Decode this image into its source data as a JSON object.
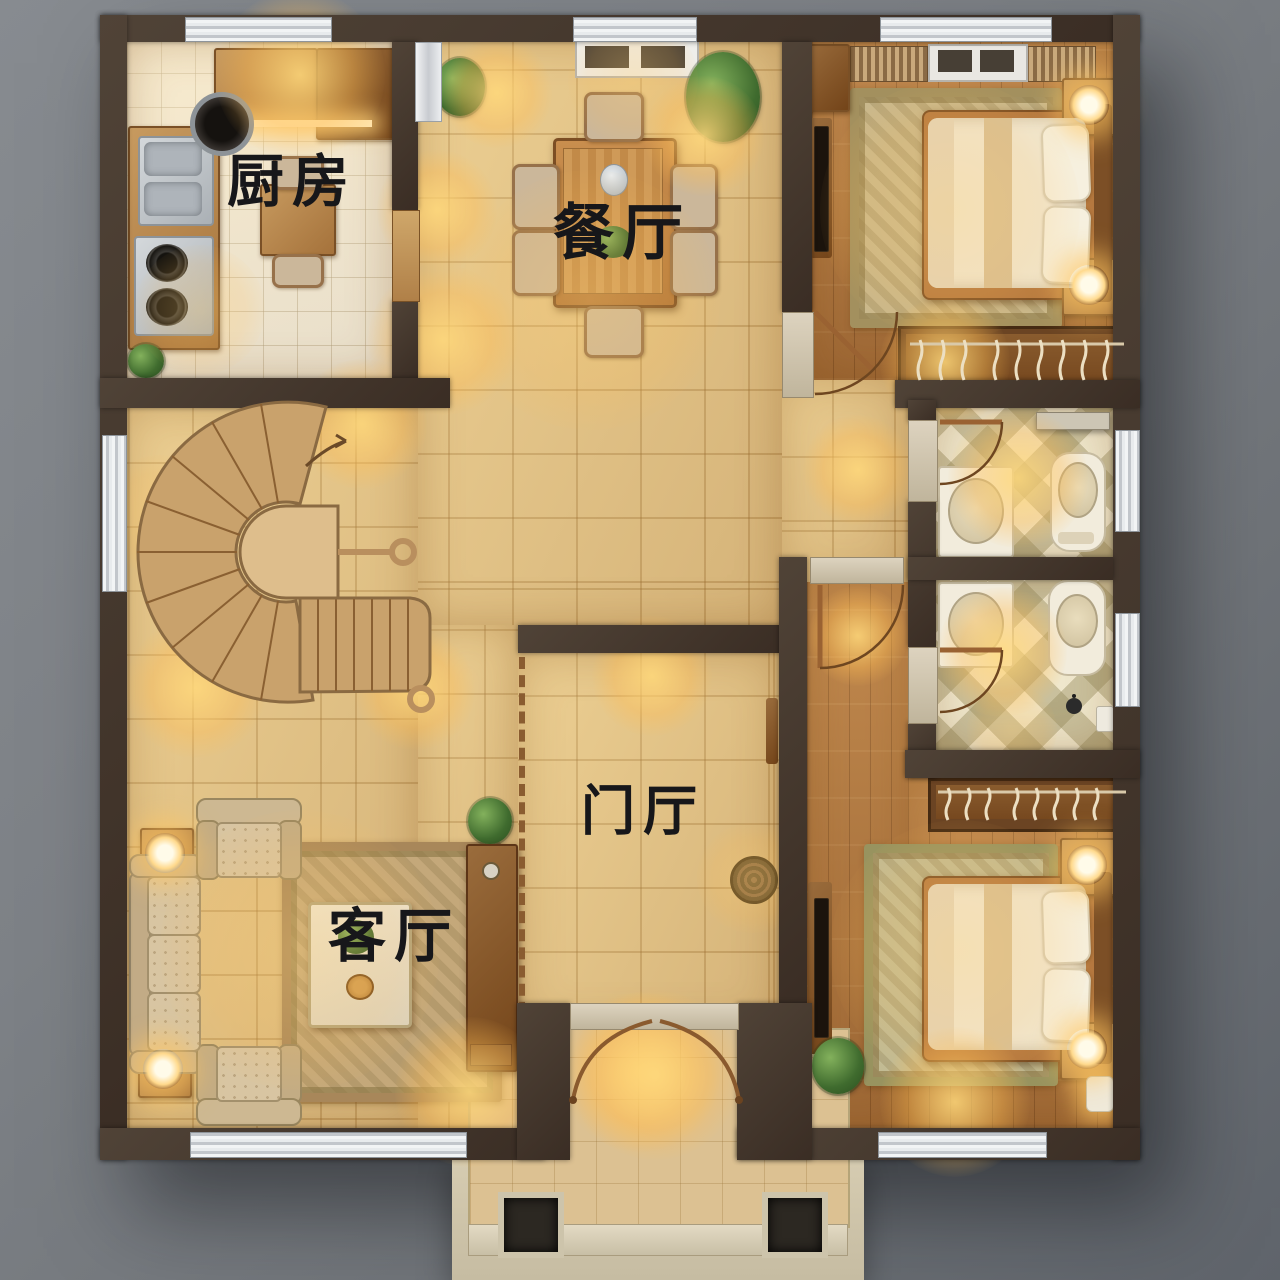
{
  "scene": {
    "type": "residential floor plan, photorealistic top-down 3D render",
    "lighting": "warm interior spotlights",
    "background_color": "#7e8287",
    "wall_color": "#46392f",
    "glow_color": "#ffd98c"
  },
  "labels": {
    "kitchen": "厨房",
    "dining": "餐厅",
    "living": "客厅",
    "foyer": "门厅"
  },
  "palette": {
    "beige_tile": "#e5c88f",
    "kitchen_tile": "#f1ebdd",
    "wood_floor": "#b57c44",
    "bath_tile": "#efe7cc",
    "stair_wood": "#c9a26c",
    "window_frame": "#eef0f2",
    "furniture_wood": "#c79a5f",
    "linen": "#f0e8d4"
  },
  "rooms": [
    {
      "name": "kitchen",
      "features": [
        "l-shaped-counter",
        "double-sink",
        "gas-stove",
        "breakfast-table",
        "wall-cabinets",
        "wok-pan",
        "plant"
      ]
    },
    {
      "name": "dining-room",
      "features": [
        "six-seat-dining-table",
        "centerpiece",
        "flower-vase",
        "two-potted-plants",
        "skylight"
      ]
    },
    {
      "name": "bedroom-top-right",
      "features": [
        "double-bed",
        "two-nightstands",
        "glowing-lamps",
        "area-rug",
        "open-wardrobe-with-hangers",
        "tv-panel",
        "slat-blinds",
        "skylight",
        "swing-door"
      ]
    },
    {
      "name": "bathroom-upper",
      "features": [
        "toilet",
        "vanity-sink",
        "diamond-checker-tile",
        "wall-shelf",
        "swing-door",
        "window"
      ]
    },
    {
      "name": "bathroom-lower",
      "features": [
        "toilet",
        "vanity-sink",
        "diamond-checker-tile",
        "swing-door",
        "window"
      ]
    },
    {
      "name": "staircase-hall",
      "features": [
        "curved-fan-staircase",
        "u-turn-landing",
        "spiral-railing-ends",
        "direction-arrow",
        "window"
      ]
    },
    {
      "name": "living-room",
      "features": [
        "three-seat-floral-sofa",
        "two-armchairs",
        "marble-coffee-table",
        "area-rug",
        "two-corner-lamp-tables",
        "divider-cabinet-with-plant",
        "dashed-slat-screen",
        "long-bottom-window"
      ]
    },
    {
      "name": "foyer",
      "features": [
        "round-rattan-mat",
        "coat-hook-board",
        "double-entry-doors",
        "threshold-lintel"
      ]
    },
    {
      "name": "bedroom-bottom-right",
      "features": [
        "double-bed",
        "two-nightstands",
        "glowing-lamps",
        "area-rug",
        "open-wardrobe-with-hangers",
        "tv-console",
        "plant",
        "candle-light",
        "long-bottom-window"
      ]
    },
    {
      "name": "hallway",
      "features": [
        "marble-threshold",
        "swing-door",
        "wood-floor"
      ]
    },
    {
      "name": "entry-porch",
      "features": [
        "two-dark-pillars",
        "step-edge",
        "tiled-landing"
      ]
    }
  ]
}
